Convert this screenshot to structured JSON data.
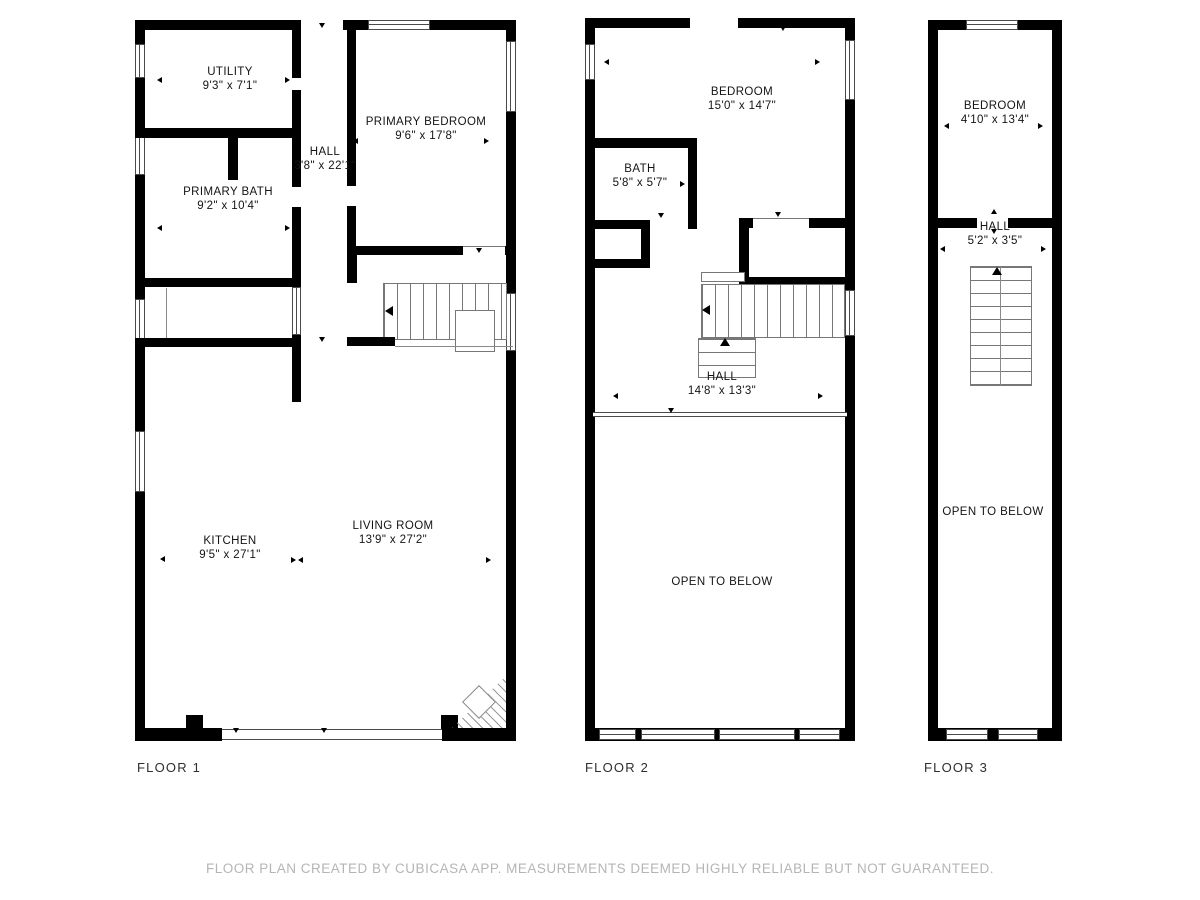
{
  "floors": [
    {
      "label": "FLOOR 1",
      "rooms": [
        {
          "name": "UTILITY",
          "dims": "9'3\" x 7'1\""
        },
        {
          "name": "PRIMARY BATH",
          "dims": "9'2\" x 10'4\""
        },
        {
          "name": "HALL",
          "dims": "3'8\" x 22'1\""
        },
        {
          "name": "PRIMARY BEDROOM",
          "dims": "9'6\" x 17'8\""
        },
        {
          "name": "KITCHEN",
          "dims": "9'5\" x 27'1\""
        },
        {
          "name": "LIVING ROOM",
          "dims": "13'9\" x 27'2\""
        }
      ]
    },
    {
      "label": "FLOOR 2",
      "rooms": [
        {
          "name": "BEDROOM",
          "dims": "15'0\" x 14'7\""
        },
        {
          "name": "BATH",
          "dims": "5'8\" x 5'7\""
        },
        {
          "name": "HALL",
          "dims": "14'8\" x 13'3\""
        },
        {
          "name": "OPEN TO BELOW"
        }
      ]
    },
    {
      "label": "FLOOR 3",
      "rooms": [
        {
          "name": "BEDROOM",
          "dims": "4'10\" x 13'4\""
        },
        {
          "name": "HALL",
          "dims": "5'2\" x 3'5\""
        },
        {
          "name": "OPEN TO BELOW"
        }
      ]
    }
  ],
  "footer": {
    "text": "FLOOR PLAN CREATED BY CUBICASA APP. MEASUREMENTS DEEMED HIGHLY RELIABLE BUT NOT GUARANTEED."
  },
  "colors": {
    "wall": "#000000",
    "thin_line": "#808080",
    "footer_text": "#b5b5b5"
  }
}
